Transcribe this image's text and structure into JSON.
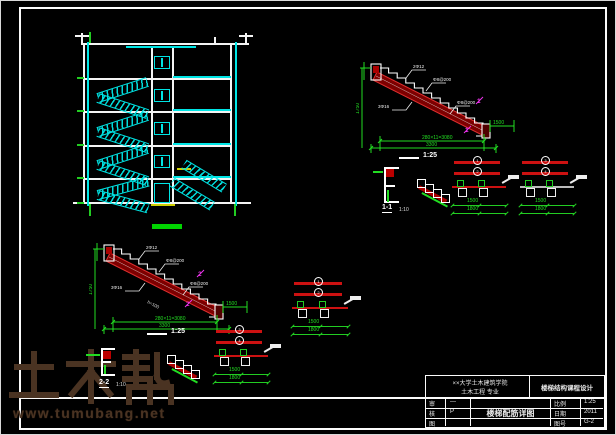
{
  "sheet": {
    "bg": "#000000",
    "frame_color": "#fbfbfb",
    "cad_cyan": "#00e5e5",
    "cad_green": "#22dd22",
    "cad_red": "#cc1111",
    "cad_magenta": "#ee33ee"
  },
  "watermark": {
    "logo": "土木帮",
    "url": "www.tumubang.net"
  },
  "labels": {
    "scale_top": "1:25",
    "scale_bottom": "1:25",
    "section_11": "1-1",
    "section_11_scale": "1:10",
    "section_22": "2-2",
    "section_22_scale": "1:10"
  },
  "flight_top": {
    "rise": "1750",
    "run": "280×11=3080",
    "total": "3300",
    "side": "1500",
    "mark1": "1",
    "mark2": "1",
    "ann1": "2Φ12",
    "ann2": "Φ8@200",
    "ann3": "3Φ16",
    "ann4": "Φ8@200"
  },
  "flight_bottom": {
    "rise": "1750",
    "run": "280×11=3080",
    "total": "3300",
    "side": "1500",
    "mark1": "2",
    "mark2": "2",
    "ann1": "2Φ12",
    "ann2": "Φ8@200",
    "ann3": "3Φ16",
    "ann4": "Φ8@200",
    "note": "h=100"
  },
  "rebar_groups": [
    {
      "c1": "1",
      "c2": "2",
      "d1": "1500",
      "d2": "1800"
    },
    {
      "c1": "3",
      "c2": "4",
      "d1": "1500",
      "d2": "1800"
    },
    {
      "c1": "1",
      "c2": "2",
      "d1": "1500",
      "d2": "1800"
    },
    {
      "c1": "3",
      "c2": "4",
      "d1": "1500",
      "d2": "1800"
    }
  ],
  "titleblock": {
    "school_line1": "××大学土木建筑学院",
    "school_line2": "土木工程 专业",
    "project": "楼梯结构课程设计",
    "drawing": "楼梯配筋详图",
    "rows_left": [
      {
        "k": "审",
        "v": "—"
      },
      {
        "k": "核",
        "v": "P"
      },
      {
        "k": "图",
        "v": ""
      }
    ],
    "rows_right": [
      {
        "k": "比例",
        "v": "1:25"
      },
      {
        "k": "日期",
        "v": "2011"
      },
      {
        "k": "图号",
        "v": "G-2"
      }
    ]
  }
}
